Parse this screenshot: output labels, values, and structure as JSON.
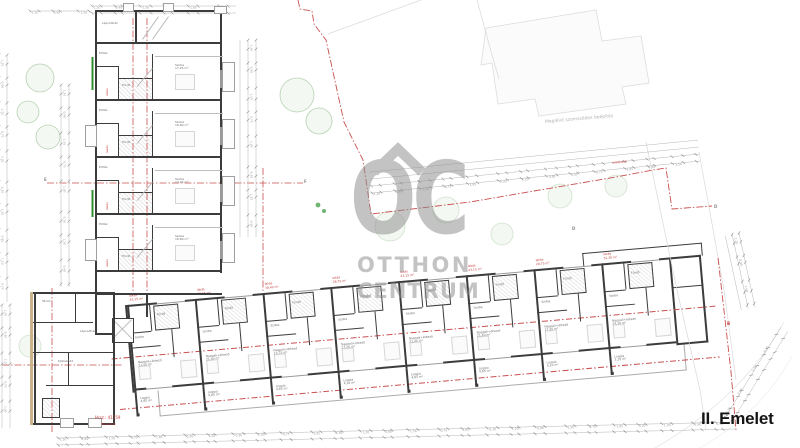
{
  "floor_label": "II. Emelet",
  "watermark": {
    "roof_icon": "house-roof",
    "logo_text": "OC",
    "brand_line1": "OTTHON",
    "brand_line2": "CENTRUM"
  },
  "labels": {
    "neighbor_building": "Meglévő szomszédos beépítés",
    "boundary": "telekhatár",
    "plot_number": "Hrsz.: 41159",
    "plot_sub": "Társasház"
  },
  "section_markers": {
    "e": "E",
    "f": "F",
    "d1": "D",
    "d2": "D",
    "b": "B"
  },
  "top_wing": {
    "stair_label": "Lépcsőház",
    "units": [
      {
        "red_label": "lakás",
        "room": "Szoba",
        "area": "17,25 m²",
        "bath": "Fürdő",
        "hall": "Előtér"
      },
      {
        "red_label": "lakás",
        "room": "Szoba",
        "area": "16,80 m²",
        "bath": "Fürdő",
        "hall": "Előtér"
      },
      {
        "red_label": "lakás",
        "room": "Szoba",
        "area": "17,25 m²",
        "bath": "Fürdő",
        "hall": "Előtér"
      },
      {
        "red_label": "lakás",
        "room": "Szoba",
        "area": "16,80 m²",
        "bath": "Fürdő",
        "hall": "Előtér"
      }
    ]
  },
  "bottom_wing": {
    "units": [
      {
        "red1": "lakás",
        "red2": "43,15 m²",
        "living": "Nappali+étkező",
        "living_area": "21,40 m²",
        "room": "Szoba",
        "bath": "Fürdő",
        "loggia": "Loggia",
        "loggia_area": "4,85 m²"
      },
      {
        "red1": "lakás",
        "red2": "43,15 m²",
        "living": "Nappali+étkező",
        "living_area": "21,40 m²",
        "room": "Szoba",
        "bath": "Fürdő",
        "loggia": "Loggia",
        "loggia_area": "4,85 m²"
      },
      {
        "red1": "lakás",
        "red2": "38,40 m²",
        "living": "Nappali+étkező",
        "living_area": "19,75 m²",
        "room": "Szoba",
        "bath": "Fürdő",
        "loggia": "Loggia",
        "loggia_area": "4,85 m²"
      },
      {
        "red1": "lakás",
        "red2": "28,75 m²",
        "living": "Nappali+étkező",
        "living_area": "17,20 m²",
        "room": "Szoba",
        "bath": "Fürdő",
        "loggia": "Loggia",
        "loggia_area": "4,10 m²"
      },
      {
        "red1": "lakás",
        "red2": "43,15 m²",
        "living": "Nappali+étkező",
        "living_area": "21,40 m²",
        "room": "Szoba",
        "bath": "Fürdő",
        "loggia": "Loggia",
        "loggia_area": "4,85 m²"
      },
      {
        "red1": "lakás",
        "red2": "43,15 m²",
        "living": "Nappali+étkező",
        "living_area": "21,40 m²",
        "room": "Szoba",
        "bath": "Fürdő",
        "loggia": "Loggia",
        "loggia_area": "4,85 m²"
      },
      {
        "red1": "lakás",
        "red2": "28,75 m²",
        "living": "Nappali+étkező",
        "living_area": "17,20 m²",
        "room": "Szoba",
        "bath": "Fürdő",
        "loggia": "Loggia",
        "loggia_area": "4,10 m²"
      },
      {
        "red1": "lakás",
        "red2": "51,30 m²",
        "living": "Nappali+étkező",
        "living_area": "24,10 m²",
        "room": "Szoba",
        "bath": "Fürdő",
        "loggia": "Loggia",
        "loggia_area": "5,10 m²"
      }
    ]
  },
  "block": {
    "store": "Tároló",
    "corridor": "Közlekedő",
    "stair": "Lépcsőház"
  },
  "dim_values": [
    "1,20",
    "2,35",
    "0,90",
    "3,05",
    "1,50",
    "4,06",
    "0,75",
    "2,10",
    "1,85",
    "5,40",
    "0,30",
    "1,64"
  ],
  "colors": {
    "red_axis": "#c85050",
    "wall": "#3c3c3c",
    "green_hedge": "#2f8f2f",
    "tree": "#8fbe8a",
    "watermark_gray": "#8e8e8e",
    "tan_wall": "#cbb389",
    "light_line": "#dcdcdc"
  }
}
